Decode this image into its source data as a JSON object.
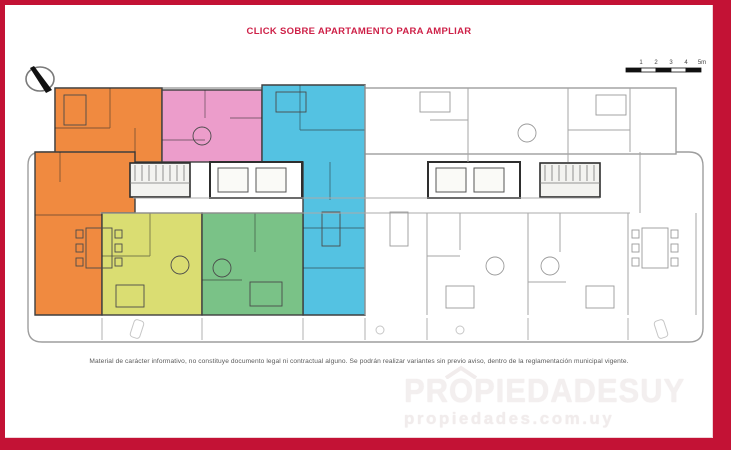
{
  "window": {
    "frame_color": "#C31235",
    "background": "#FFFFFF"
  },
  "header": {
    "title": "CLICK SOBRE APARTAMENTO PARA AMPLIAR",
    "title_color": "#CE2148"
  },
  "scale_bar": {
    "labels": [
      "1",
      "2",
      "3",
      "4",
      "5m"
    ]
  },
  "apartments": [
    {
      "id": "apartment-orange-top-left",
      "color": "#F08A40"
    },
    {
      "id": "apartment-orange-left",
      "color": "#F08A40"
    },
    {
      "id": "apartment-pink",
      "color": "#EC9DCB"
    },
    {
      "id": "apartment-cyan",
      "color": "#54C2E2"
    },
    {
      "id": "apartment-yellow",
      "color": "#DADD72"
    },
    {
      "id": "apartment-green",
      "color": "#7AC287"
    }
  ],
  "footer": {
    "disclaimer": "Material de carácter informativo, no constituye documento legal ni contractual alguno. Se podrán realizar variantes sin previo aviso, dentro de la reglamentación municipal vigente."
  },
  "watermark": {
    "brand": "PROPIEDADESUY",
    "url": "propiedades.com.uy"
  }
}
